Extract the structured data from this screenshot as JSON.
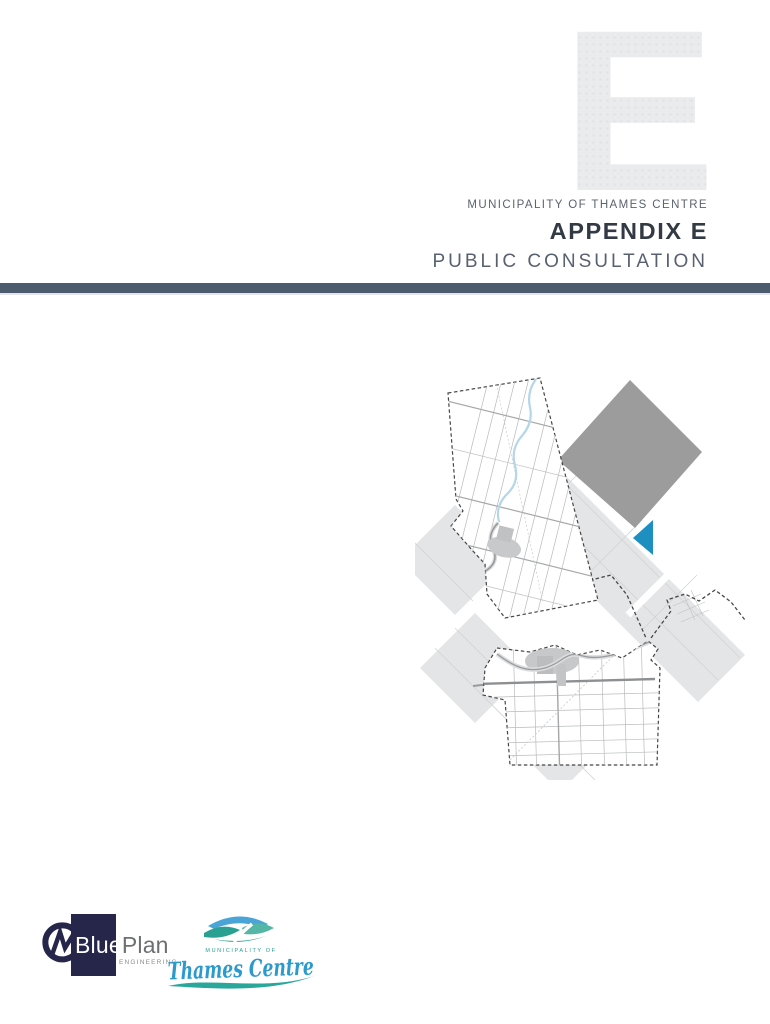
{
  "header": {
    "watermark_letter": "E",
    "kicker": "MUNICIPALITY OF THAMES CENTRE",
    "title": "APPENDIX E",
    "subtitle": "PUBLIC CONSULTATION"
  },
  "footer": {
    "blueplan": {
      "monogram": "GM",
      "word_blue": "Blue",
      "word_plan": "Plan",
      "tagline": "ENGINEERING"
    },
    "thames_centre": {
      "kicker": "MUNICIPALITY OF",
      "name": "Thames Centre"
    }
  },
  "colors": {
    "accent_bar": "#4d5b6e",
    "title_text": "#333a44",
    "muted_text": "#5b6270",
    "watermark_gray": "#eaebec",
    "map_tile_gray": "#e4e5e7",
    "solid_diamond_gray": "#9c9c9c",
    "highlight_blue": "#1e8fc1",
    "blueplan_navy": "#26264a",
    "blueplan_gray": "#6e6f71",
    "thames_script_blue": "#2d9ace",
    "thames_teal": "#2aa092"
  },
  "icons": {
    "gm_monogram": "GM circle monogram",
    "thames_landscape": "hills and river emblem",
    "thames_swoosh": "wave underline",
    "map_collage": "municipal boundary map over diamond tiles"
  }
}
